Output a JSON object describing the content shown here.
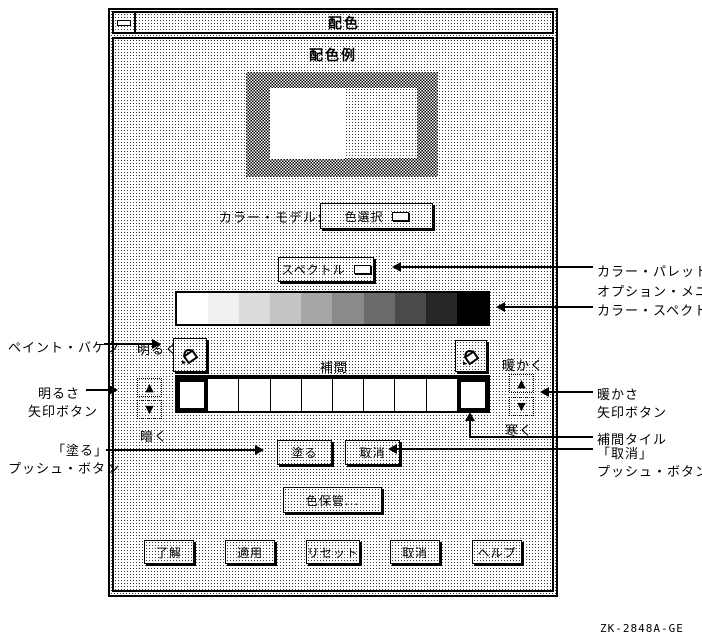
{
  "window": {
    "title": "配色"
  },
  "dialog": {
    "title": "配色例"
  },
  "color_model": {
    "label": "カラー・モデル:",
    "selected": "色選択"
  },
  "palette_menu": {
    "selected": "スペクトル"
  },
  "spectrum": {
    "segments": [
      "#ffffff",
      "#f0f0f0",
      "#dcdcdc",
      "#c4c4c4",
      "#a6a6a6",
      "#8a8a8a",
      "#6b6b6b",
      "#4a4a4a",
      "#262626",
      "#000000"
    ]
  },
  "labels": {
    "brighter": "明るく",
    "darker": "暗く",
    "warmer": "暖かく",
    "colder": "寒く",
    "interp": "補間"
  },
  "icons": {
    "up_arrow": "▲",
    "down_arrow": "▼"
  },
  "tiles": {
    "count": 10,
    "selected": [
      0,
      9
    ]
  },
  "buttons": {
    "paint": "塗る",
    "cancel": "取消",
    "save": "色保管..."
  },
  "actions": {
    "ok": "了解",
    "apply": "適用",
    "reset": "リセット",
    "cancel": "取消",
    "help": "ヘルプ"
  },
  "annotations": {
    "palette_menu": [
      "カラー・パレット",
      "オプション・メニュー"
    ],
    "color_spectrum": "カラー・スペクトル",
    "warmth_arrows": [
      "暖かさ",
      "矢印ボタン"
    ],
    "interp_tile": "補間タイル",
    "cancel_push": [
      "「取消」",
      "プッシュ・ボタン"
    ],
    "paint_bucket": "ペイント・バケツ",
    "brightness_arrows": [
      "明るさ",
      "矢印ボタン"
    ],
    "paint_push": [
      "「塗る」",
      "プッシュ・ボタン"
    ]
  },
  "footer": {
    "figure_id": "ZK-2848A-GE"
  },
  "colors": {
    "ink": "#000000",
    "paper": "#ffffff"
  }
}
